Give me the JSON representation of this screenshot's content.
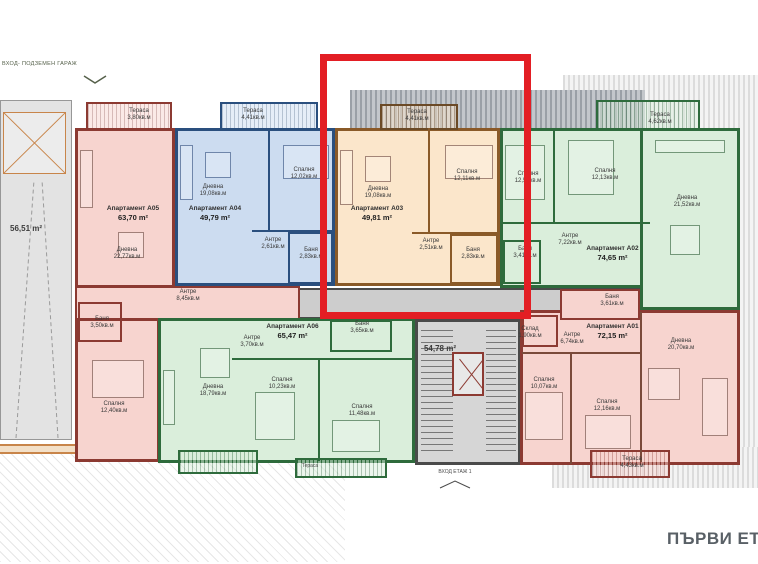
{
  "floor_label": "ПЪРВИ ЕТА",
  "site": {
    "garage_entrance_label": "ВХОД- ПОДЗЕМЕН ГАРАЖ",
    "ramp_area": "56,51 m²",
    "stairwell_area": "54,78 m²",
    "building_entrance_label": "ВХОД ЕТАЖ 1"
  },
  "highlight": {
    "target_apartment": "Апартамент А03",
    "color": "#e31e24"
  },
  "colors": {
    "highlight_red": "#e31e24",
    "pink_fill": "#f7d4cf",
    "pink_wall": "#8c3a32",
    "blue_fill": "#ccdcf0",
    "blue_wall": "#2a4f7e",
    "orange_fill": "#fbe6cb",
    "orange_wall": "#8a5a28",
    "green_fill": "#daeedb",
    "green_wall": "#2e6b3c",
    "corridor_gray": "#cdcdcd"
  },
  "apartments": [
    {
      "id": "A05",
      "name": "Апартамент А05",
      "area": "63,70 m²",
      "color_name": "pink",
      "rooms": [
        {
          "label": "Тераса",
          "area": "3,80кв.м"
        },
        {
          "label": "Дневна",
          "area": "22,77кв.м"
        },
        {
          "label": "Антре",
          "area": "8,45кв.м"
        },
        {
          "label": "Баня",
          "area": "3,50кв.м"
        },
        {
          "label": "Спалня",
          "area": "12,40кв.м"
        }
      ]
    },
    {
      "id": "A04",
      "name": "Апартамент А04",
      "area": "49,79 m²",
      "color_name": "blue",
      "rooms": [
        {
          "label": "Тераса",
          "area": "4,41кв.м"
        },
        {
          "label": "Дневна",
          "area": "19,08кв.м"
        },
        {
          "label": "Спалня",
          "area": "12,02кв.м"
        },
        {
          "label": "Антре",
          "area": "2,61кв.м"
        },
        {
          "label": "Баня",
          "area": "2,83кв.м"
        }
      ]
    },
    {
      "id": "A03",
      "name": "Апартамент А03",
      "area": "49,81 m²",
      "color_name": "orange",
      "rooms": [
        {
          "label": "Тераса",
          "area": "4,41кв.м"
        },
        {
          "label": "Дневна",
          "area": "19,08кв.м"
        },
        {
          "label": "Спалня",
          "area": "12,11кв.м"
        },
        {
          "label": "Антре",
          "area": "2,51кв.м"
        },
        {
          "label": "Баня",
          "area": "2,83кв.м"
        }
      ]
    },
    {
      "id": "A02",
      "name": "Апартамент А02",
      "area": "74,65 m²",
      "color_name": "green",
      "rooms": [
        {
          "label": "Тераса",
          "area": "4,62кв.м"
        },
        {
          "label": "Спалня",
          "area": "12,50кв.м"
        },
        {
          "label": "Спалня",
          "area": "12,13кв.м"
        },
        {
          "label": "Дневна",
          "area": "21,52кв.м"
        },
        {
          "label": "Антре",
          "area": "7,22кв.м"
        },
        {
          "label": "Баня",
          "area": "3,41кв.м"
        }
      ]
    },
    {
      "id": "A01",
      "name": "Апартамент А01",
      "area": "72,15 m²",
      "color_name": "pink",
      "rooms": [
        {
          "label": "Баня",
          "area": "3,61кв.м"
        },
        {
          "label": "Склад",
          "area": "1,90кв.м"
        },
        {
          "label": "Антре",
          "area": "6,74кв.м"
        },
        {
          "label": "Дневна",
          "area": "20,70кв.м"
        },
        {
          "label": "Спалня",
          "area": "10,07кв.м"
        },
        {
          "label": "Спалня",
          "area": "12,16кв.м"
        },
        {
          "label": "Тераса",
          "area": "4,43кв.м"
        }
      ]
    },
    {
      "id": "A06",
      "name": "Апартамент А06",
      "area": "65,47 m²",
      "color_name": "green",
      "rooms": [
        {
          "label": "Антре",
          "area": "3,70кв.м"
        },
        {
          "label": "Баня",
          "area": "3,65кв.м"
        },
        {
          "label": "Дневна",
          "area": "18,79кв.м"
        },
        {
          "label": "Спалня",
          "area": "10,23кв.м"
        },
        {
          "label": "Спалня",
          "area": "11,48кв.м"
        },
        {
          "label": "Тераса",
          "area": ""
        }
      ]
    }
  ]
}
